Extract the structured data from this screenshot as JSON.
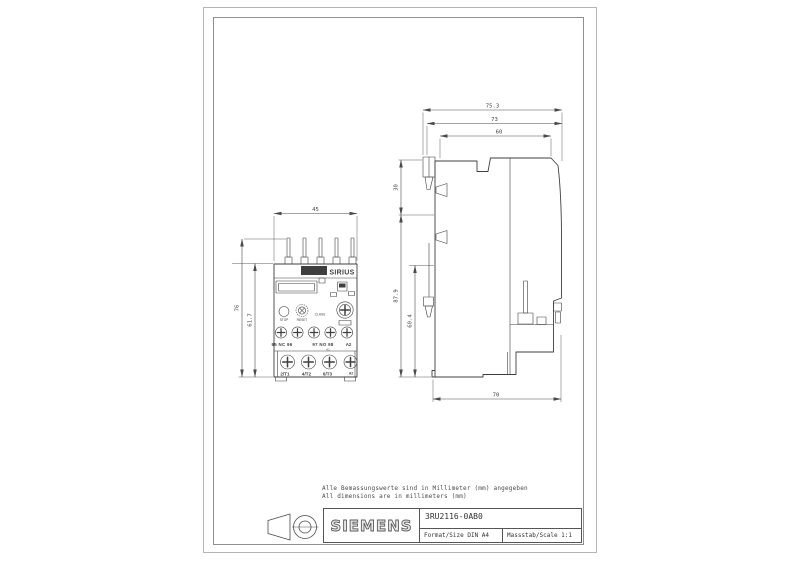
{
  "document": {
    "type": "technical-dimension-drawing"
  },
  "notes": {
    "line1": "Alle Bemassungswerte sind in Millimeter (mm) angegeben",
    "line2": "All dimensions are in millimeters (mm)"
  },
  "title_block": {
    "brand": "SIEMENS",
    "part_number": "3RU2116-0AB0",
    "format": "Format/Size DIN A4",
    "scale": "Massstab/Scale 1:1"
  },
  "front_view": {
    "header": {
      "brand": "SIEMENS",
      "series": "SIRIUS"
    },
    "controls": {
      "stop": "STOP",
      "reset": "RESET",
      "class_label": "CLASS"
    },
    "terminals": {
      "aux_left": "95 NC 96",
      "aux_right": "97 NO 98",
      "aux_mark": "A1",
      "aux_a2": "A2",
      "main": [
        "2/T1",
        "4/T2",
        "6/T3",
        "A2"
      ]
    },
    "dims": {
      "width": "45",
      "height_total": "76",
      "height_body": "61.7"
    }
  },
  "side_view": {
    "dims": {
      "total_depth": "75.3",
      "depth_mid": "73",
      "depth_body": "60",
      "height_top": "30",
      "height_total": "87.9",
      "height_lower": "60.4",
      "bottom_depth": "70"
    }
  },
  "colors": {
    "line": "#3f3f3f",
    "dim": "#4a4a4a",
    "frame": "#9a9a9a"
  }
}
